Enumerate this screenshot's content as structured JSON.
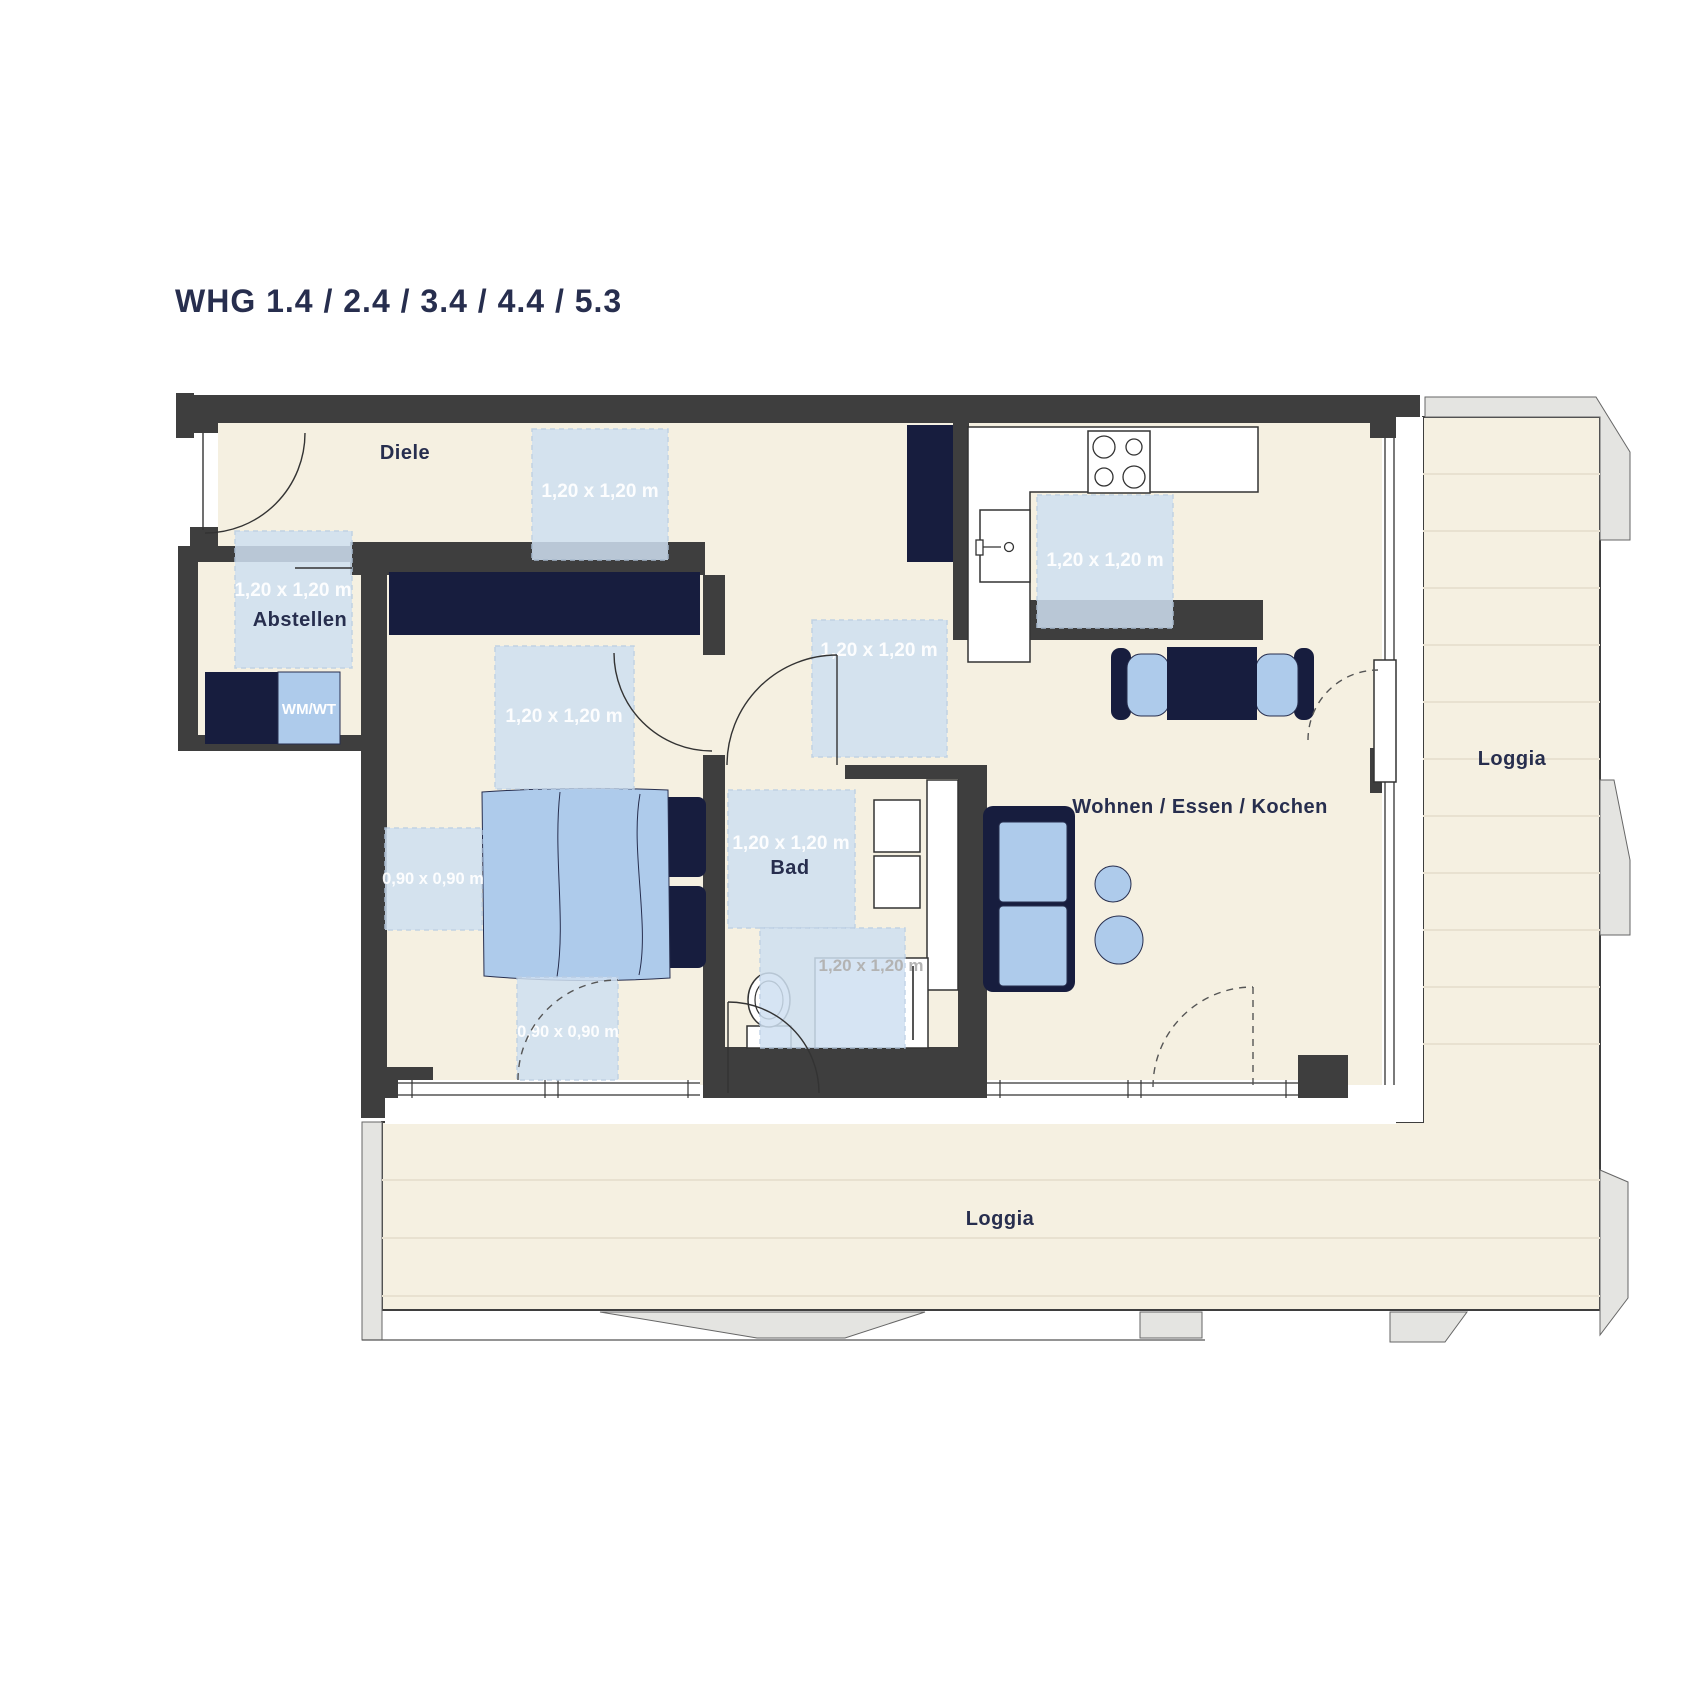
{
  "title": "WHG 1.4 / 2.4 / 3.4 / 4.4 / 5.3",
  "colors": {
    "wall": "#3e3e3e",
    "navy_text": "#272e4e",
    "furniture_navy": "#171d3e",
    "floor_cream": "#f5f0e1",
    "furniture_blue": "#aecbeb",
    "dim_square_blue": "#cfe0f1",
    "exterior_gray": "#e4e4e1",
    "outline": "#333333"
  },
  "rooms": {
    "diele": "Diele",
    "abstellen": "Abstellen",
    "bad": "Bad",
    "living": "Wohnen / Essen / Kochen",
    "loggia_right": "Loggia",
    "loggia_bottom": "Loggia"
  },
  "appliances": {
    "wm_wt": "WM/WT"
  },
  "dimension_squares": [
    {
      "id": "diele-clearance",
      "x": 532,
      "y": 429,
      "w": 136,
      "h": 131,
      "label": "1,20 x 1,20 m",
      "lx": 600,
      "ly": 497,
      "fs": 19
    },
    {
      "id": "abstellen-clearance",
      "x": 235,
      "y": 531,
      "w": 117,
      "h": 137,
      "label": "1,20 x 1,20 m",
      "lx": 293,
      "ly": 596,
      "fs": 19
    },
    {
      "id": "corridor-clearance",
      "x": 812,
      "y": 620,
      "w": 135,
      "h": 137,
      "label": "1,20 x 1,20 m",
      "lx": 879,
      "ly": 656,
      "fs": 19
    },
    {
      "id": "bedroom-clearance",
      "x": 495,
      "y": 646,
      "w": 139,
      "h": 143,
      "label": "1,20 x 1,20 m",
      "lx": 564,
      "ly": 722,
      "fs": 19
    },
    {
      "id": "bad-clearance",
      "x": 728,
      "y": 790,
      "w": 127,
      "h": 138,
      "label": "1,20 x 1,20 m",
      "lx": 791,
      "ly": 849,
      "fs": 19
    },
    {
      "id": "kitchen-clearance",
      "x": 1037,
      "y": 495,
      "w": 136,
      "h": 133,
      "label": "1,20 x 1,20 m",
      "lx": 1105,
      "ly": 566,
      "fs": 19
    },
    {
      "id": "bedroom-clearance-90a",
      "x": 385,
      "y": 828,
      "w": 97,
      "h": 102,
      "label": "0,90 x 0,90 m",
      "lx": 433,
      "ly": 884,
      "fs": 16.5
    },
    {
      "id": "bedroom-clearance-90b",
      "x": 517,
      "y": 977,
      "w": 101,
      "h": 103,
      "label": "0,90 x 0,90 m",
      "lx": 568,
      "ly": 1037,
      "fs": 16.5
    },
    {
      "id": "shower-clearance",
      "x": 760,
      "y": 928,
      "w": 145,
      "h": 120,
      "label": "",
      "lx": 0,
      "ly": 0,
      "fs": 0
    }
  ],
  "free_labels": [
    {
      "id": "shower-dim-label",
      "text": "1,20 x 1,20 m",
      "x": 871,
      "y": 971
    }
  ]
}
